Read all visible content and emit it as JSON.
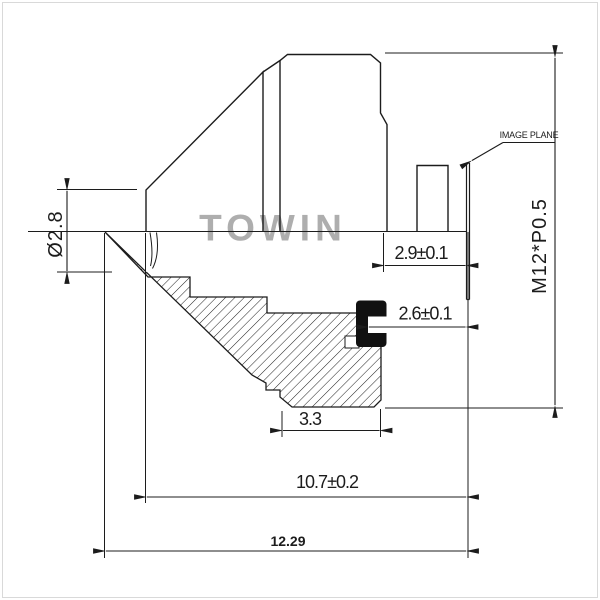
{
  "drawing": {
    "watermark": "TOWIN",
    "annotations": {
      "image_plane": "IMAGE PLANE",
      "thread_spec": "M12*P0.5"
    },
    "dimensions": {
      "front_diameter": "Ø2.8",
      "clearance_2_9": "2.9±0.1",
      "bfl_2_6": "2.6±0.1",
      "rear_width": "3.3",
      "mount_to_image": "10.7±0.2",
      "total_length": "12.29"
    },
    "colors": {
      "line": "#1c1c1c",
      "watermark_gray": "#aeaeae",
      "background": "#ffffff",
      "filter_black": "#111111",
      "frame_border": "#d9d9d9"
    }
  }
}
